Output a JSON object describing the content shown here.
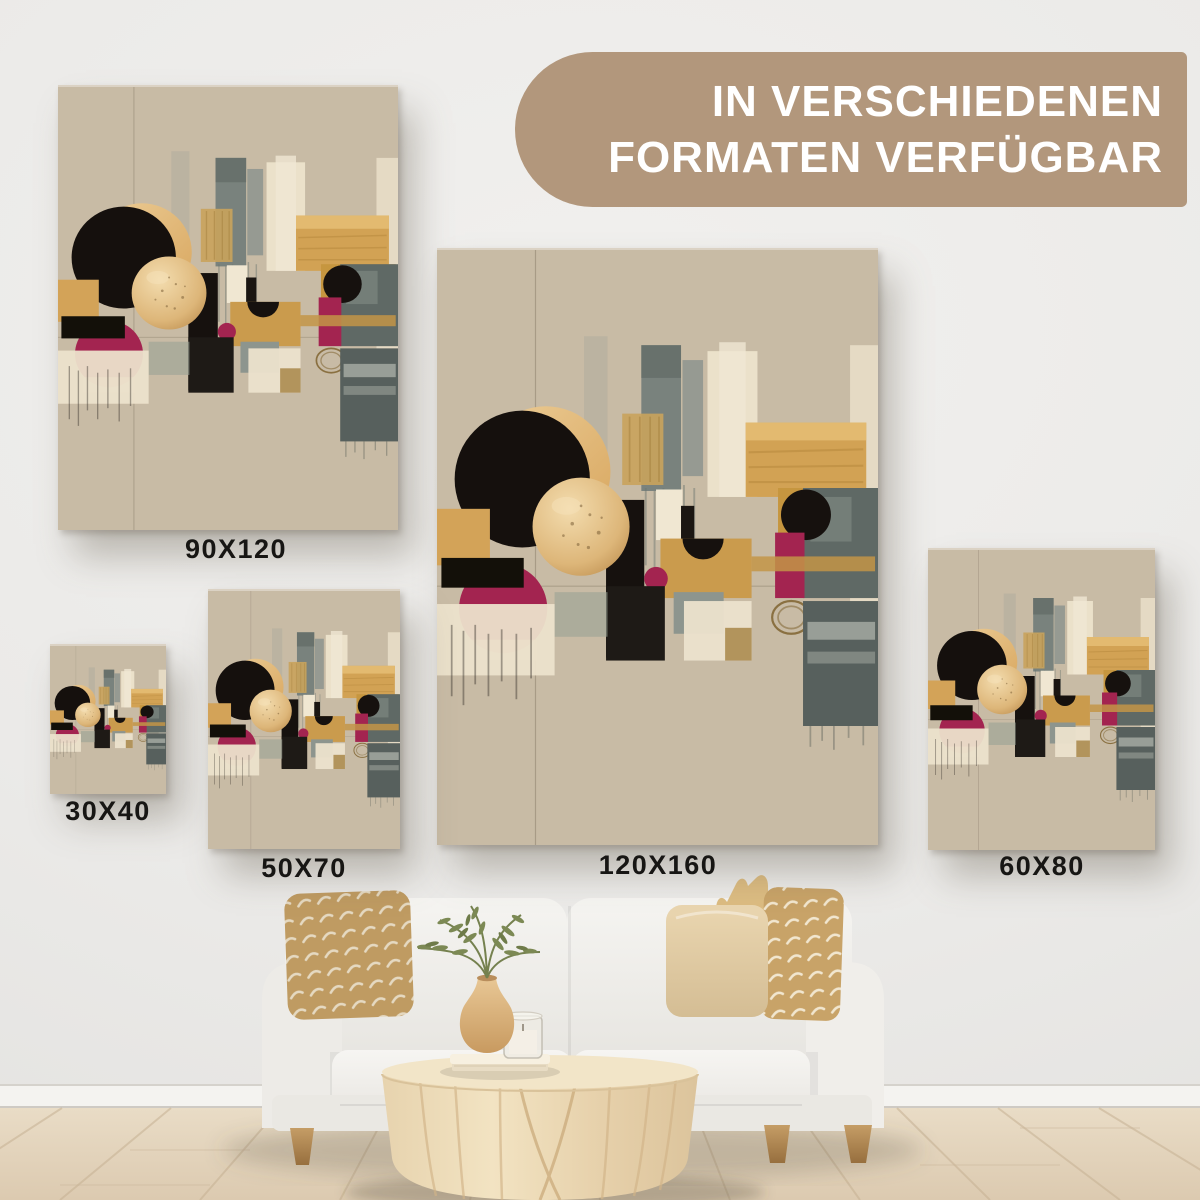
{
  "badge": {
    "line1": "IN VERSCHIEDENEN",
    "line2": "FORMATEN VERFÜGBAR"
  },
  "formats": [
    {
      "label": "90X120"
    },
    {
      "label": "30X40"
    },
    {
      "label": "50X70"
    },
    {
      "label": "120X160"
    },
    {
      "label": "60X80"
    }
  ],
  "colors": {
    "badge_bg": "#b2977c",
    "label_text": "#171614",
    "art_bg": "#c8bba5",
    "art_black": "#16110e",
    "art_gold": "#d2a254",
    "art_magenta": "#a32450",
    "art_slate": "#5f6965",
    "art_cream": "#ece2cc"
  }
}
